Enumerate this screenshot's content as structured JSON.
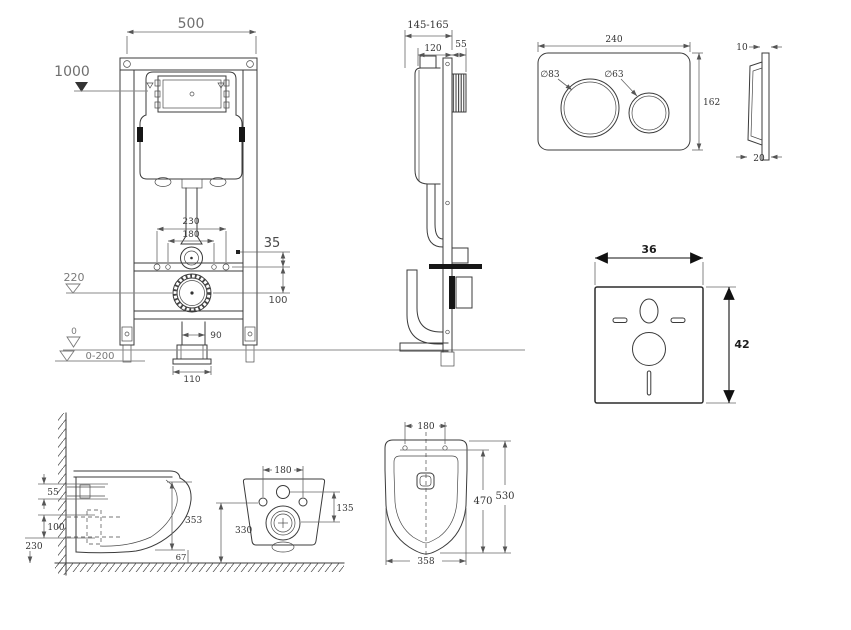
{
  "drawing": {
    "type": "wall-hung toilet installation frame technical drawing"
  },
  "views": {
    "frame_front": {
      "width": "500",
      "install_height": "1000",
      "flush_pipe_span": "230",
      "bolt_span": "180",
      "rail_offset": "35",
      "drain_height": "220",
      "drain_offset": "100",
      "foot_span": "90",
      "base_span": "110",
      "floor_level": "0",
      "adjust_range": "0-200"
    },
    "frame_side": {
      "depth_range": "145-165",
      "frame_depth": "120",
      "bracket_depth": "55"
    },
    "flush_plate_front": {
      "width": "240",
      "height": "162",
      "big_button_dia": "∅83",
      "small_button_dia": "∅63"
    },
    "flush_plate_side": {
      "top_thickness": "10",
      "bottom_thickness": "20"
    },
    "sound_mat": {
      "width": "36",
      "height": "42"
    },
    "toilet_side": {
      "seat_to_bolt": "55",
      "bolt_spacing": "100",
      "drain_height": "230",
      "bowl_height": "353",
      "bottom_clearance": "67"
    },
    "toilet_rear": {
      "bolt_span": "180",
      "inlet_to_drain": "135",
      "bolt_height": "330"
    },
    "toilet_top": {
      "bolt_span": "180",
      "inner_length": "470",
      "length": "530",
      "width": "358"
    }
  }
}
